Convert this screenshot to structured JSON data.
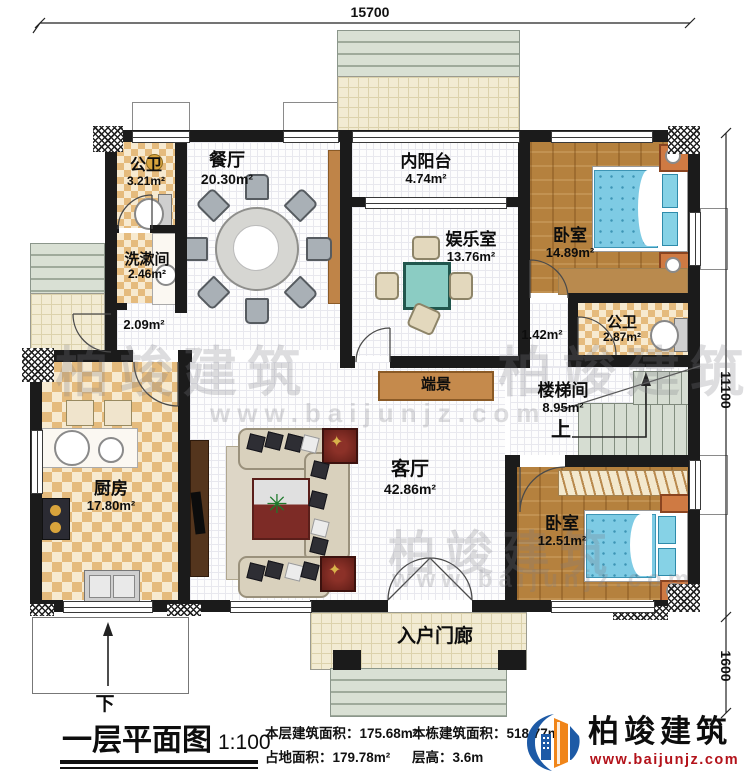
{
  "dimensions": {
    "top": "15700",
    "right": "11100",
    "bottom_right": "1600"
  },
  "rooms": {
    "bath1": {
      "name": "公卫",
      "area": "3.21m²"
    },
    "wash": {
      "name": "洗漱间",
      "area": "2.46m²"
    },
    "hall": {
      "area": "2.09m²"
    },
    "dining": {
      "name": "餐厅",
      "area": "20.30m²"
    },
    "balcony": {
      "name": "内阳台",
      "area": "4.74m²"
    },
    "rec": {
      "name": "娱乐室",
      "area": "13.76m²"
    },
    "bed1": {
      "name": "卧室",
      "area": "14.89m²"
    },
    "corridor": {
      "area": "1.42m²"
    },
    "bath2": {
      "name": "公卫",
      "area": "2.87m²"
    },
    "stair": {
      "name": "楼梯间",
      "area": "8.95m²",
      "up_label": "上"
    },
    "kitchen": {
      "name": "厨房",
      "area": "17.80m²"
    },
    "living": {
      "name": "客厅",
      "area": "42.86m²"
    },
    "console": {
      "name": "端景"
    },
    "bed2": {
      "name": "卧室",
      "area": "12.51m²"
    },
    "porch": {
      "name": "入户门廊"
    },
    "ramp": {
      "down_label": "下"
    }
  },
  "footer": {
    "title": "一层平面图",
    "scale": "1:100",
    "stats": [
      "本层建筑面积：175.68m²",
      "占地面积：179.78m²",
      "本栋建筑面积：518.77m²",
      "层高：3.6m"
    ]
  },
  "logo": {
    "name": "柏竣建筑",
    "url": "www.baijunjz.com"
  },
  "watermark": {
    "text": "柏竣建筑",
    "url": "www.baijunjz.com"
  },
  "icons": {
    "plant": "✳",
    "flower": "✦"
  }
}
